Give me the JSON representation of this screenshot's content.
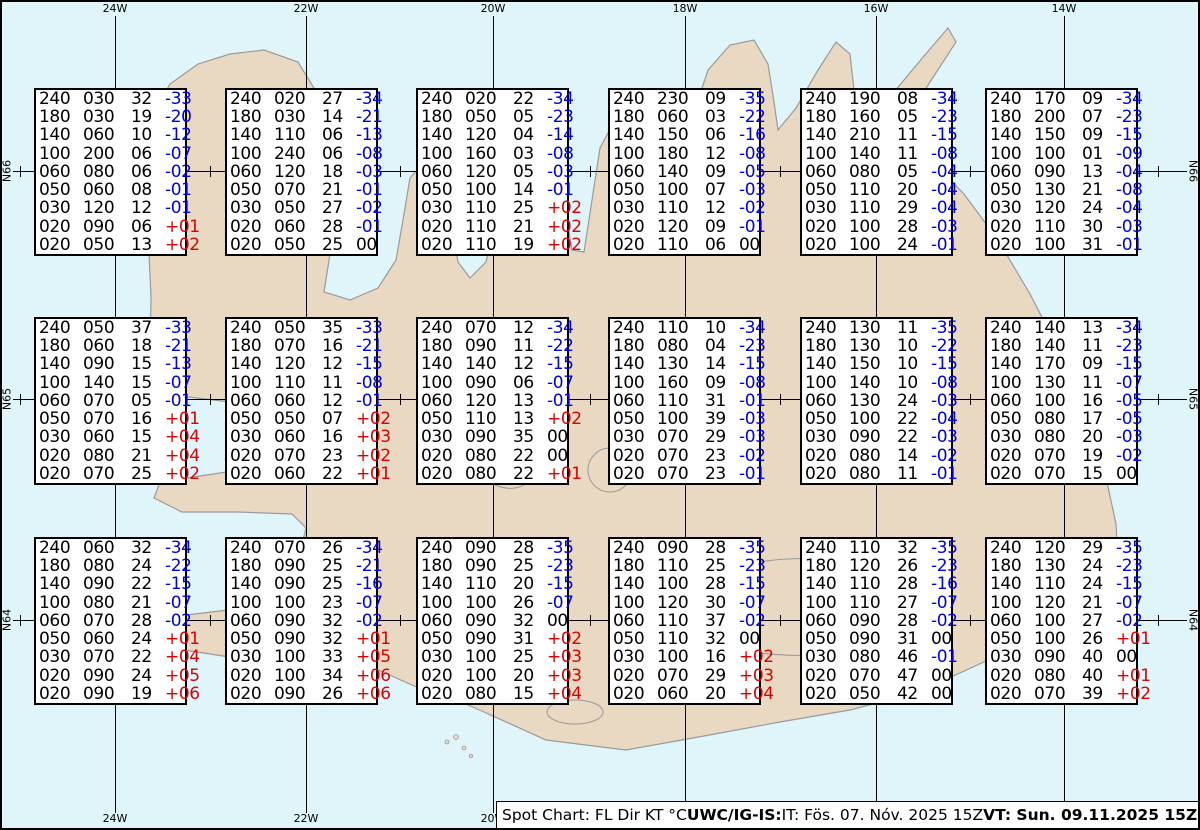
{
  "colors": {
    "sea": "#e0f5f9",
    "land": "#e9d8c2",
    "coast": "#9a9a9a",
    "negative_temp": "#0000dd",
    "positive_temp": "#dd0000",
    "grid": "#000000"
  },
  "grid": {
    "meridians": [
      "24W",
      "22W",
      "20W",
      "18W",
      "16W",
      "14W"
    ],
    "parallels": [
      "N66",
      "N65",
      "N64"
    ]
  },
  "caption": {
    "segments": [
      {
        "text": "Spot Chart: FL Dir KT °C ",
        "bold": false
      },
      {
        "text": "UWC/IG-IS:",
        "bold": true
      },
      {
        "text": " IT: Fös. 07. Nóv. 2025 15Z ",
        "bold": false
      },
      {
        "text": "VT: Sun. 09.11.2025 15Z",
        "bold": true
      },
      {
        "text": " (+48 h)",
        "bold": false
      }
    ]
  },
  "stations": [
    {
      "row": 0,
      "col": 0,
      "lines": [
        [
          "240",
          "030",
          "32",
          "-33"
        ],
        [
          "180",
          "030",
          "19",
          "-20"
        ],
        [
          "140",
          "060",
          "10",
          "-12"
        ],
        [
          "100",
          "200",
          "06",
          "-07"
        ],
        [
          "060",
          "080",
          "06",
          "-02"
        ],
        [
          "050",
          "060",
          "08",
          "-01"
        ],
        [
          "030",
          "120",
          "12",
          "-01"
        ],
        [
          "020",
          "090",
          "06",
          "+01"
        ],
        [
          "020",
          "050",
          "13",
          "+02"
        ]
      ]
    },
    {
      "row": 0,
      "col": 1,
      "lines": [
        [
          "240",
          "020",
          "27",
          "-34"
        ],
        [
          "180",
          "030",
          "14",
          "-21"
        ],
        [
          "140",
          "110",
          "06",
          "-13"
        ],
        [
          "100",
          "240",
          "06",
          "-08"
        ],
        [
          "060",
          "120",
          "18",
          "-03"
        ],
        [
          "050",
          "070",
          "21",
          "-01"
        ],
        [
          "030",
          "050",
          "27",
          "-02"
        ],
        [
          "020",
          "060",
          "28",
          "-01"
        ],
        [
          "020",
          "050",
          "25",
          "00"
        ]
      ]
    },
    {
      "row": 0,
      "col": 2,
      "lines": [
        [
          "240",
          "020",
          "22",
          "-34"
        ],
        [
          "180",
          "050",
          "05",
          "-23"
        ],
        [
          "140",
          "120",
          "04",
          "-14"
        ],
        [
          "100",
          "160",
          "03",
          "-08"
        ],
        [
          "060",
          "120",
          "05",
          "-03"
        ],
        [
          "050",
          "100",
          "14",
          "-01"
        ],
        [
          "030",
          "110",
          "25",
          "+02"
        ],
        [
          "020",
          "110",
          "21",
          "+02"
        ],
        [
          "020",
          "110",
          "19",
          "+02"
        ]
      ]
    },
    {
      "row": 0,
      "col": 3,
      "lines": [
        [
          "240",
          "230",
          "09",
          "-35"
        ],
        [
          "180",
          "060",
          "03",
          "-22"
        ],
        [
          "140",
          "150",
          "06",
          "-16"
        ],
        [
          "100",
          "180",
          "12",
          "-08"
        ],
        [
          "060",
          "140",
          "09",
          "-05"
        ],
        [
          "050",
          "100",
          "07",
          "-03"
        ],
        [
          "030",
          "110",
          "12",
          "-02"
        ],
        [
          "020",
          "120",
          "09",
          "-01"
        ],
        [
          "020",
          "110",
          "06",
          "00"
        ]
      ]
    },
    {
      "row": 0,
      "col": 4,
      "lines": [
        [
          "240",
          "190",
          "08",
          "-34"
        ],
        [
          "180",
          "160",
          "05",
          "-23"
        ],
        [
          "140",
          "210",
          "11",
          "-15"
        ],
        [
          "100",
          "140",
          "11",
          "-08"
        ],
        [
          "060",
          "080",
          "05",
          "-04"
        ],
        [
          "050",
          "110",
          "20",
          "-04"
        ],
        [
          "030",
          "110",
          "29",
          "-04"
        ],
        [
          "020",
          "100",
          "28",
          "-03"
        ],
        [
          "020",
          "100",
          "24",
          "-01"
        ]
      ]
    },
    {
      "row": 0,
      "col": 5,
      "lines": [
        [
          "240",
          "170",
          "09",
          "-34"
        ],
        [
          "180",
          "200",
          "07",
          "-23"
        ],
        [
          "140",
          "150",
          "09",
          "-15"
        ],
        [
          "100",
          "100",
          "01",
          "-09"
        ],
        [
          "060",
          "090",
          "13",
          "-04"
        ],
        [
          "050",
          "130",
          "21",
          "-08"
        ],
        [
          "030",
          "120",
          "24",
          "-04"
        ],
        [
          "020",
          "110",
          "30",
          "-03"
        ],
        [
          "020",
          "100",
          "31",
          "-01"
        ]
      ]
    },
    {
      "row": 1,
      "col": 0,
      "lines": [
        [
          "240",
          "050",
          "37",
          "-33"
        ],
        [
          "180",
          "060",
          "18",
          "-21"
        ],
        [
          "140",
          "090",
          "15",
          "-13"
        ],
        [
          "100",
          "140",
          "15",
          "-07"
        ],
        [
          "060",
          "070",
          "05",
          "-01"
        ],
        [
          "050",
          "070",
          "16",
          "+01"
        ],
        [
          "030",
          "060",
          "15",
          "+04"
        ],
        [
          "020",
          "080",
          "21",
          "+04"
        ],
        [
          "020",
          "070",
          "25",
          "+02"
        ]
      ]
    },
    {
      "row": 1,
      "col": 1,
      "lines": [
        [
          "240",
          "050",
          "35",
          "-33"
        ],
        [
          "180",
          "070",
          "16",
          "-21"
        ],
        [
          "140",
          "120",
          "12",
          "-15"
        ],
        [
          "100",
          "110",
          "11",
          "-08"
        ],
        [
          "060",
          "060",
          "12",
          "-01"
        ],
        [
          "050",
          "050",
          "07",
          "+02"
        ],
        [
          "030",
          "060",
          "16",
          "+03"
        ],
        [
          "020",
          "070",
          "23",
          "+02"
        ],
        [
          "020",
          "060",
          "22",
          "+01"
        ]
      ]
    },
    {
      "row": 1,
      "col": 2,
      "lines": [
        [
          "240",
          "070",
          "12",
          "-34"
        ],
        [
          "180",
          "090",
          "11",
          "-22"
        ],
        [
          "140",
          "140",
          "12",
          "-15"
        ],
        [
          "100",
          "090",
          "06",
          "-07"
        ],
        [
          "060",
          "120",
          "13",
          "-01"
        ],
        [
          "050",
          "110",
          "13",
          "+02"
        ],
        [
          "030",
          "090",
          "35",
          "00"
        ],
        [
          "020",
          "080",
          "22",
          "00"
        ],
        [
          "020",
          "080",
          "22",
          "+01"
        ]
      ]
    },
    {
      "row": 1,
      "col": 3,
      "lines": [
        [
          "240",
          "110",
          "10",
          "-34"
        ],
        [
          "180",
          "080",
          "04",
          "-23"
        ],
        [
          "140",
          "130",
          "14",
          "-15"
        ],
        [
          "100",
          "160",
          "09",
          "-08"
        ],
        [
          "060",
          "110",
          "31",
          "-01"
        ],
        [
          "050",
          "100",
          "39",
          "-03"
        ],
        [
          "030",
          "070",
          "29",
          "-03"
        ],
        [
          "020",
          "070",
          "23",
          "-02"
        ],
        [
          "020",
          "070",
          "23",
          "-01"
        ]
      ]
    },
    {
      "row": 1,
      "col": 4,
      "lines": [
        [
          "240",
          "130",
          "11",
          "-35"
        ],
        [
          "180",
          "130",
          "10",
          "-22"
        ],
        [
          "140",
          "150",
          "10",
          "-15"
        ],
        [
          "100",
          "140",
          "10",
          "-08"
        ],
        [
          "060",
          "130",
          "24",
          "-03"
        ],
        [
          "050",
          "100",
          "22",
          "-04"
        ],
        [
          "030",
          "090",
          "22",
          "-03"
        ],
        [
          "020",
          "080",
          "14",
          "-02"
        ],
        [
          "020",
          "080",
          "11",
          "-01"
        ]
      ]
    },
    {
      "row": 1,
      "col": 5,
      "lines": [
        [
          "240",
          "140",
          "13",
          "-34"
        ],
        [
          "180",
          "140",
          "11",
          "-23"
        ],
        [
          "140",
          "170",
          "09",
          "-15"
        ],
        [
          "100",
          "130",
          "11",
          "-07"
        ],
        [
          "060",
          "100",
          "16",
          "-05"
        ],
        [
          "050",
          "080",
          "17",
          "-05"
        ],
        [
          "030",
          "080",
          "20",
          "-03"
        ],
        [
          "020",
          "070",
          "19",
          "-02"
        ],
        [
          "020",
          "070",
          "15",
          "00"
        ]
      ]
    },
    {
      "row": 2,
      "col": 0,
      "lines": [
        [
          "240",
          "060",
          "32",
          "-34"
        ],
        [
          "180",
          "080",
          "24",
          "-22"
        ],
        [
          "140",
          "090",
          "22",
          "-15"
        ],
        [
          "100",
          "080",
          "21",
          "-07"
        ],
        [
          "060",
          "070",
          "28",
          "-02"
        ],
        [
          "050",
          "060",
          "24",
          "+01"
        ],
        [
          "030",
          "070",
          "22",
          "+04"
        ],
        [
          "020",
          "090",
          "24",
          "+05"
        ],
        [
          "020",
          "090",
          "19",
          "+06"
        ]
      ]
    },
    {
      "row": 2,
      "col": 1,
      "lines": [
        [
          "240",
          "070",
          "26",
          "-34"
        ],
        [
          "180",
          "090",
          "25",
          "-21"
        ],
        [
          "140",
          "090",
          "25",
          "-16"
        ],
        [
          "100",
          "100",
          "23",
          "-07"
        ],
        [
          "060",
          "090",
          "32",
          "-02"
        ],
        [
          "050",
          "090",
          "32",
          "+01"
        ],
        [
          "030",
          "100",
          "33",
          "+05"
        ],
        [
          "020",
          "100",
          "34",
          "+06"
        ],
        [
          "020",
          "090",
          "26",
          "+06"
        ]
      ]
    },
    {
      "row": 2,
      "col": 2,
      "lines": [
        [
          "240",
          "090",
          "28",
          "-35"
        ],
        [
          "180",
          "090",
          "25",
          "-23"
        ],
        [
          "140",
          "110",
          "20",
          "-15"
        ],
        [
          "100",
          "100",
          "26",
          "-07"
        ],
        [
          "060",
          "090",
          "32",
          "00"
        ],
        [
          "050",
          "090",
          "31",
          "+02"
        ],
        [
          "030",
          "100",
          "25",
          "+03"
        ],
        [
          "020",
          "100",
          "20",
          "+03"
        ],
        [
          "020",
          "080",
          "15",
          "+04"
        ]
      ]
    },
    {
      "row": 2,
      "col": 3,
      "lines": [
        [
          "240",
          "090",
          "28",
          "-35"
        ],
        [
          "180",
          "110",
          "25",
          "-23"
        ],
        [
          "140",
          "100",
          "28",
          "-15"
        ],
        [
          "100",
          "120",
          "30",
          "-07"
        ],
        [
          "060",
          "110",
          "37",
          "-02"
        ],
        [
          "050",
          "110",
          "32",
          "00"
        ],
        [
          "030",
          "100",
          "16",
          "+02"
        ],
        [
          "020",
          "070",
          "29",
          "+03"
        ],
        [
          "020",
          "060",
          "20",
          "+04"
        ]
      ]
    },
    {
      "row": 2,
      "col": 4,
      "lines": [
        [
          "240",
          "110",
          "32",
          "-35"
        ],
        [
          "180",
          "120",
          "26",
          "-23"
        ],
        [
          "140",
          "110",
          "28",
          "-16"
        ],
        [
          "100",
          "110",
          "27",
          "-07"
        ],
        [
          "060",
          "090",
          "28",
          "-02"
        ],
        [
          "050",
          "090",
          "31",
          "00"
        ],
        [
          "030",
          "080",
          "46",
          "-01"
        ],
        [
          "020",
          "070",
          "47",
          "00"
        ],
        [
          "020",
          "050",
          "42",
          "00"
        ]
      ]
    },
    {
      "row": 2,
      "col": 5,
      "lines": [
        [
          "240",
          "120",
          "29",
          "-35"
        ],
        [
          "180",
          "130",
          "24",
          "-23"
        ],
        [
          "140",
          "110",
          "24",
          "-15"
        ],
        [
          "100",
          "120",
          "21",
          "-07"
        ],
        [
          "060",
          "100",
          "27",
          "-02"
        ],
        [
          "050",
          "100",
          "26",
          "+01"
        ],
        [
          "030",
          "090",
          "40",
          "00"
        ],
        [
          "020",
          "080",
          "40",
          "+01"
        ],
        [
          "020",
          "070",
          "39",
          "+02"
        ]
      ]
    }
  ]
}
